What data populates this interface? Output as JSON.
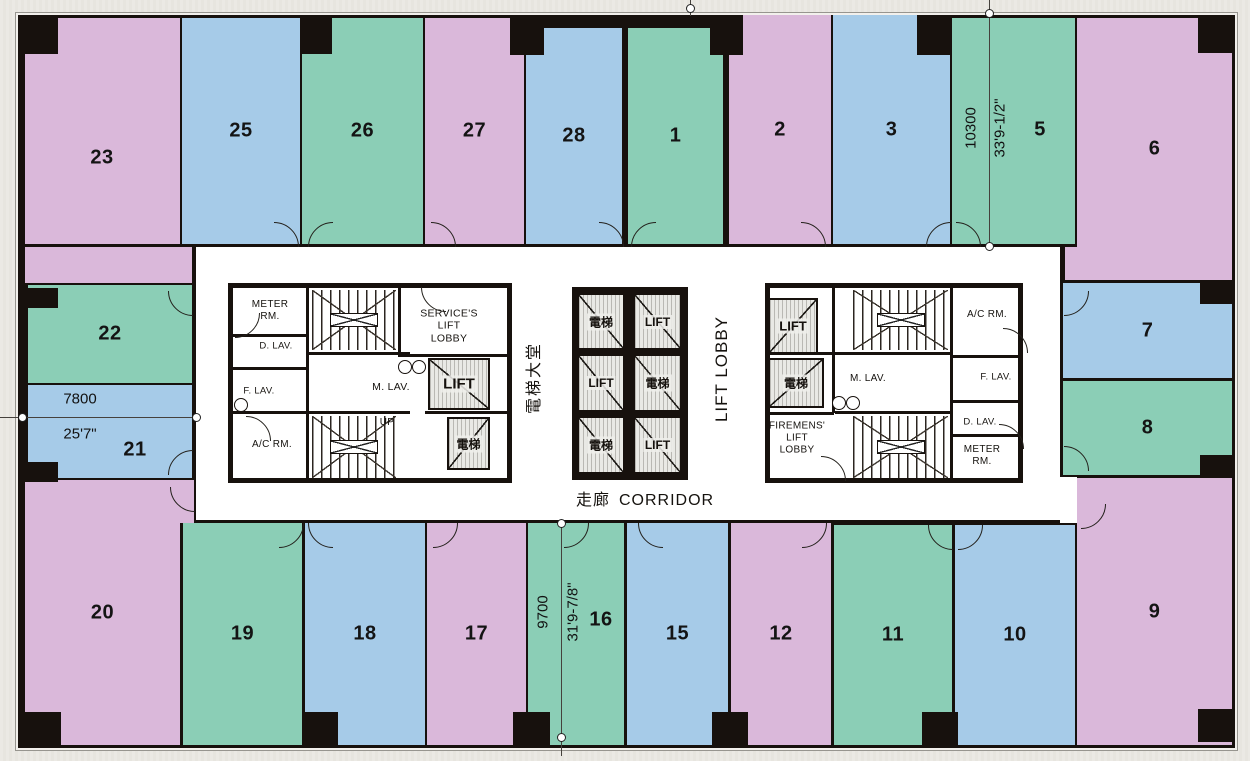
{
  "colors": {
    "pink": "#dab8da",
    "blue": "#a6cbe8",
    "teal": "#8bceb6",
    "wall": "#17110d",
    "core_bg": "#ffffff",
    "page_bg": "#eae8e2",
    "shaft_fill": "#e9e9e5",
    "column": "#17110d"
  },
  "building": {
    "x": 18,
    "y": 15,
    "w": 1211,
    "h": 727
  },
  "core": {
    "x": 196,
    "y": 247,
    "w": 864,
    "h": 273
  },
  "units": [
    {
      "label": "23",
      "color": "pink",
      "x": 25,
      "y": 18,
      "w": 155,
      "h": 226,
      "lx": 102,
      "ly": 158
    },
    {
      "label": "25",
      "color": "blue",
      "x": 182,
      "y": 18,
      "w": 118,
      "h": 226
    },
    {
      "label": "26",
      "color": "teal",
      "x": 302,
      "y": 18,
      "w": 121,
      "h": 226
    },
    {
      "label": "27",
      "color": "pink",
      "x": 425,
      "y": 18,
      "w": 99,
      "h": 226
    },
    {
      "label": "28",
      "color": "blue",
      "x": 526,
      "y": 28,
      "w": 96,
      "h": 216
    },
    {
      "label": "1",
      "color": "teal",
      "x": 628,
      "y": 28,
      "w": 95,
      "h": 216
    },
    {
      "label": "2",
      "color": "pink",
      "x": 729,
      "y": 15,
      "w": 102,
      "h": 229
    },
    {
      "label": "3",
      "color": "blue",
      "x": 833,
      "y": 15,
      "w": 117,
      "h": 229
    },
    {
      "label": "5",
      "color": "teal",
      "x": 952,
      "y": 18,
      "w": 123,
      "h": 226,
      "lx": 1040,
      "ly": 130
    },
    {
      "label": "6",
      "color": "pink",
      "x": 1077,
      "y": 18,
      "w": 155,
      "h": 262
    },
    {
      "label": "22",
      "color": "teal",
      "x": 28,
      "y": 285,
      "w": 164,
      "h": 98
    },
    {
      "label": "21",
      "color": "blue",
      "x": 28,
      "y": 385,
      "w": 164,
      "h": 93,
      "lx": 135,
      "ly": 450
    },
    {
      "label": "7",
      "color": "blue",
      "x": 1063,
      "y": 283,
      "w": 169,
      "h": 95
    },
    {
      "label": "8",
      "color": "teal",
      "x": 1063,
      "y": 381,
      "w": 169,
      "h": 94
    },
    {
      "label": "20",
      "color": "pink",
      "x": 25,
      "y": 480,
      "w": 155,
      "h": 265
    },
    {
      "label": "19",
      "color": "teal",
      "x": 183,
      "y": 523,
      "w": 119,
      "h": 222
    },
    {
      "label": "18",
      "color": "blue",
      "x": 305,
      "y": 523,
      "w": 120,
      "h": 222
    },
    {
      "label": "17",
      "color": "pink",
      "x": 427,
      "y": 523,
      "w": 99,
      "h": 222
    },
    {
      "label": "16",
      "color": "teal",
      "x": 528,
      "y": 523,
      "w": 96,
      "h": 222,
      "lx": 601,
      "ly": 620
    },
    {
      "label": "15",
      "color": "blue",
      "x": 627,
      "y": 523,
      "w": 101,
      "h": 222
    },
    {
      "label": "12",
      "color": "pink",
      "x": 731,
      "y": 523,
      "w": 100,
      "h": 222
    },
    {
      "label": "11",
      "color": "teal",
      "x": 834,
      "y": 525,
      "w": 118,
      "h": 220
    },
    {
      "label": "10",
      "color": "blue",
      "x": 955,
      "y": 525,
      "w": 120,
      "h": 220
    },
    {
      "label": "9",
      "color": "pink",
      "x": 1077,
      "y": 478,
      "w": 155,
      "h": 267
    }
  ],
  "patches": [
    {
      "color": "pink",
      "x": 25,
      "y": 247,
      "w": 167,
      "h": 36
    },
    {
      "color": "pink",
      "x": 1065,
      "y": 247,
      "w": 167,
      "h": 33
    },
    {
      "color": "pink",
      "x": 178,
      "y": 480,
      "w": 16,
      "h": 43
    },
    {
      "color": "core_bg",
      "x": 1060,
      "y": 477,
      "w": 17,
      "h": 46
    }
  ],
  "columns": [
    [
      22,
      18,
      36,
      36
    ],
    [
      300,
      18,
      32,
      36
    ],
    [
      510,
      15,
      34,
      40
    ],
    [
      710,
      15,
      33,
      40
    ],
    [
      917,
      15,
      34,
      40
    ],
    [
      1198,
      15,
      34,
      38
    ],
    [
      22,
      288,
      36,
      20
    ],
    [
      22,
      462,
      36,
      20
    ],
    [
      1200,
      283,
      33,
      21
    ],
    [
      1200,
      455,
      33,
      20
    ],
    [
      25,
      712,
      36,
      33
    ],
    [
      303,
      712,
      35,
      33
    ],
    [
      513,
      712,
      37,
      33
    ],
    [
      712,
      712,
      36,
      33
    ],
    [
      922,
      712,
      36,
      33
    ],
    [
      1198,
      709,
      34,
      33
    ]
  ],
  "core_blocks": [
    {
      "x": 228,
      "y": 283,
      "w": 284,
      "h": 200
    },
    {
      "x": 765,
      "y": 283,
      "w": 258,
      "h": 200
    }
  ],
  "partitions": [
    [
      306,
      288,
      3,
      190
    ],
    [
      231,
      334,
      76,
      3
    ],
    [
      231,
      367,
      76,
      3
    ],
    [
      231,
      411,
      76,
      3
    ],
    [
      398,
      288,
      3,
      68
    ],
    [
      306,
      352,
      104,
      3
    ],
    [
      306,
      411,
      104,
      3
    ],
    [
      398,
      354,
      114,
      3
    ],
    [
      425,
      411,
      87,
      3
    ],
    [
      832,
      288,
      3,
      125
    ],
    [
      768,
      352,
      66,
      3
    ],
    [
      768,
      412,
      66,
      3
    ],
    [
      950,
      288,
      3,
      192
    ],
    [
      950,
      355,
      73,
      3
    ],
    [
      950,
      400,
      73,
      3
    ],
    [
      950,
      434,
      73,
      3
    ],
    [
      835,
      352,
      117,
      3
    ],
    [
      835,
      411,
      117,
      3
    ]
  ],
  "stairs": [
    {
      "x": 312,
      "y": 290,
      "w": 84,
      "h": 60
    },
    {
      "x": 312,
      "y": 416,
      "w": 84,
      "h": 62
    },
    {
      "x": 853,
      "y": 290,
      "w": 95,
      "h": 60
    },
    {
      "x": 853,
      "y": 416,
      "w": 95,
      "h": 62
    }
  ],
  "lift_shafts": [
    {
      "label": "LIFT",
      "x": 428,
      "y": 358,
      "w": 62,
      "h": 52,
      "diag": "up",
      "fs": 15
    },
    {
      "label": "電梯",
      "x": 447,
      "y": 417,
      "w": 43,
      "h": 53,
      "diag": "down",
      "fs": 12
    },
    {
      "label": "LIFT",
      "x": 768,
      "y": 298,
      "w": 50,
      "h": 56,
      "diag": "down",
      "fs": 13
    },
    {
      "label": "電梯",
      "x": 768,
      "y": 358,
      "w": 56,
      "h": 50,
      "diag": "down",
      "fs": 12
    }
  ],
  "lift_bank": {
    "frame": {
      "x": 572,
      "y": 287,
      "w": 116,
      "h": 193
    },
    "cells": [
      {
        "label": "電梯",
        "x": 577,
        "y": 293,
        "w": 48,
        "h": 57,
        "diag": "up"
      },
      {
        "label": "LIFT",
        "x": 633,
        "y": 293,
        "w": 49,
        "h": 57,
        "diag": "up"
      },
      {
        "label": "LIFT",
        "x": 577,
        "y": 354,
        "w": 48,
        "h": 58,
        "diag": "up"
      },
      {
        "label": "電梯",
        "x": 633,
        "y": 354,
        "w": 49,
        "h": 58,
        "diag": "up"
      },
      {
        "label": "電梯",
        "x": 577,
        "y": 416,
        "w": 48,
        "h": 58,
        "diag": "up"
      },
      {
        "label": "LIFT",
        "x": 633,
        "y": 416,
        "w": 49,
        "h": 58,
        "diag": "up"
      }
    ]
  },
  "room_labels": [
    {
      "t": "METER\nRM.",
      "x": 270,
      "y": 311,
      "s": 10
    },
    {
      "t": "D. LAV.",
      "x": 276,
      "y": 346,
      "s": 9.5
    },
    {
      "t": "F. LAV.",
      "x": 259,
      "y": 391,
      "s": 9.5
    },
    {
      "t": "A/C RM.",
      "x": 272,
      "y": 445,
      "s": 10
    },
    {
      "t": "SERVICE'S\nLIFT\nLOBBY",
      "x": 449,
      "y": 326,
      "s": 10.5
    },
    {
      "t": "M. LAV.",
      "x": 391,
      "y": 387,
      "s": 10.5
    },
    {
      "t": "UP",
      "x": 387,
      "y": 423,
      "s": 10
    },
    {
      "t": "A/C RM.",
      "x": 987,
      "y": 315,
      "s": 10
    },
    {
      "t": "M. LAV.",
      "x": 868,
      "y": 379,
      "s": 10
    },
    {
      "t": "F. LAV.",
      "x": 996,
      "y": 377,
      "s": 9.5
    },
    {
      "t": "D. LAV.",
      "x": 980,
      "y": 422,
      "s": 9.5
    },
    {
      "t": "METER\nRM.",
      "x": 982,
      "y": 456,
      "s": 10
    },
    {
      "t": "FIREMENS'\nLIFT\nLOBBY",
      "x": 797,
      "y": 438,
      "s": 10
    }
  ],
  "corridor": {
    "zh": "走廊",
    "en": "CORRIDOR",
    "x": 645,
    "y": 498
  },
  "vertical_labels": [
    {
      "t": "電梯大堂",
      "x": 532,
      "y": 378,
      "s": 16,
      "ls": 2
    },
    {
      "t": "LIFT LOBBY",
      "x": 722,
      "y": 369,
      "s": 17,
      "ls": 1
    }
  ],
  "door_arcs": [
    [
      273,
      246,
      "tr"
    ],
    [
      332,
      246,
      "tl"
    ],
    [
      430,
      246,
      "tr"
    ],
    [
      598,
      246,
      "tr"
    ],
    [
      655,
      246,
      "tl"
    ],
    [
      800,
      246,
      "tr"
    ],
    [
      950,
      246,
      "tl"
    ],
    [
      955,
      246,
      "tr"
    ],
    [
      278,
      522,
      "br"
    ],
    [
      332,
      522,
      "bl"
    ],
    [
      432,
      522,
      "br"
    ],
    [
      563,
      522,
      "br"
    ],
    [
      662,
      522,
      "bl"
    ],
    [
      801,
      522,
      "br"
    ],
    [
      952,
      524,
      "bl"
    ],
    [
      957,
      524,
      "br"
    ],
    [
      1080,
      503,
      "br"
    ],
    [
      194,
      486,
      "bl"
    ],
    [
      192,
      290,
      "bl"
    ],
    [
      192,
      474,
      "tl"
    ],
    [
      1063,
      290,
      "br"
    ],
    [
      1063,
      470,
      "tr"
    ],
    [
      445,
      286,
      "bl"
    ],
    [
      820,
      480,
      "tr"
    ],
    [
      245,
      440,
      "tr"
    ],
    [
      234,
      312,
      "br"
    ],
    [
      1002,
      352,
      "tr"
    ],
    [
      998,
      448,
      "tr"
    ]
  ],
  "fixtures": [
    [
      404,
      366
    ],
    [
      418,
      366
    ],
    [
      240,
      404
    ],
    [
      838,
      402
    ],
    [
      852,
      402
    ]
  ],
  "dimensions": [
    {
      "id": "dim-10300",
      "type": "v",
      "x": 989,
      "y1": 0,
      "y2": 246,
      "circles": [
        [
          989,
          13
        ],
        [
          989,
          246
        ]
      ],
      "texts": [
        {
          "t": "10300",
          "x": 971,
          "y": 128,
          "rot": true
        },
        {
          "t": "33'9-1/2\"",
          "x": 1000,
          "y": 128,
          "rot": true
        }
      ]
    },
    {
      "id": "dim-9700",
      "type": "v",
      "x": 561,
      "y1": 520,
      "y2": 756,
      "circles": [
        [
          561,
          523
        ],
        [
          561,
          737
        ]
      ],
      "texts": [
        {
          "t": "9700",
          "x": 543,
          "y": 612,
          "rot": true
        },
        {
          "t": "31'9-7/8\"",
          "x": 573,
          "y": 612,
          "rot": true
        }
      ]
    },
    {
      "id": "dim-7800",
      "type": "h",
      "y": 417,
      "x1": 0,
      "x2": 196,
      "circles": [
        [
          22,
          417
        ],
        [
          196,
          417
        ]
      ],
      "texts": [
        {
          "t": "7800",
          "x": 80,
          "y": 399,
          "rot": false
        },
        {
          "t": "25'7\"",
          "x": 80,
          "y": 434,
          "rot": false
        }
      ]
    },
    {
      "id": "grid-marker",
      "type": "v",
      "x": 690,
      "y1": 0,
      "y2": 16,
      "circles": [
        [
          690,
          8
        ]
      ],
      "texts": []
    }
  ]
}
